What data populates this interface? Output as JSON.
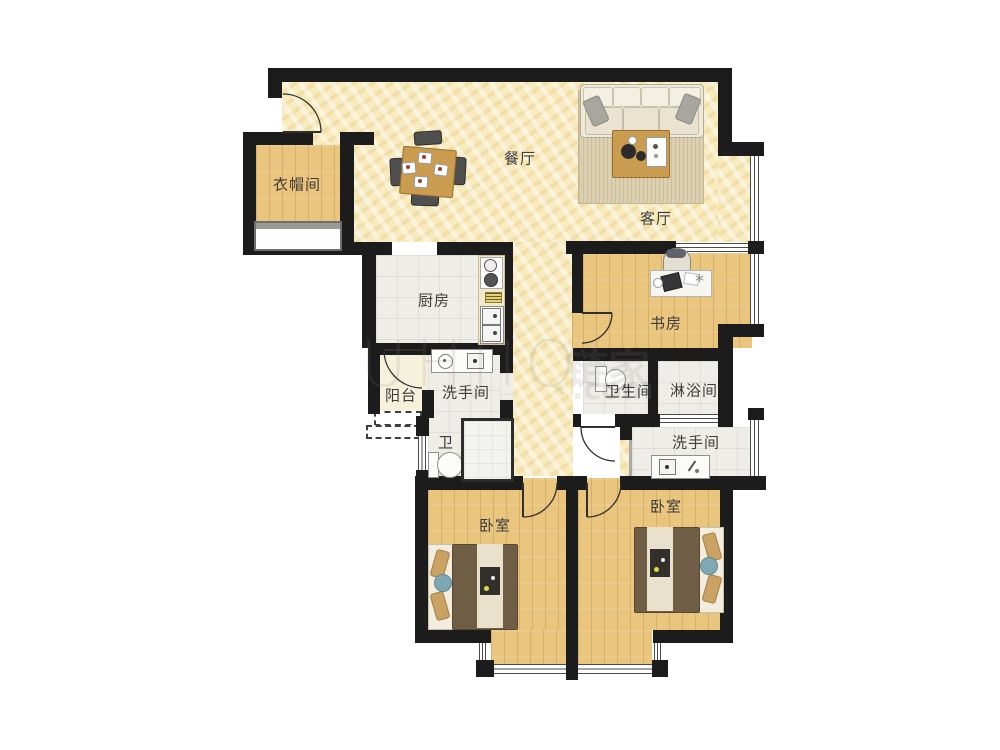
{
  "rooms": [
    {
      "key": "dining",
      "label": "餐厅"
    },
    {
      "key": "living",
      "label": "客厅"
    },
    {
      "key": "cloakroom",
      "label": "衣帽间"
    },
    {
      "key": "kitchen",
      "label": "厨房"
    },
    {
      "key": "study",
      "label": "书房"
    },
    {
      "key": "balcony",
      "label": "阳台"
    },
    {
      "key": "washroom1",
      "label": "洗手间"
    },
    {
      "key": "toilet",
      "label": "卫"
    },
    {
      "key": "bathroom",
      "label": "卫生间"
    },
    {
      "key": "shower",
      "label": "淋浴间"
    },
    {
      "key": "washroom2",
      "label": "洗手间"
    },
    {
      "key": "bedroom-left",
      "label": "卧室"
    },
    {
      "key": "bedroom-right",
      "label": "卧室"
    }
  ],
  "watermark": {
    "latin": "UHJIQ",
    "cjk": "链家",
    "suffix": ".com"
  },
  "palette": {
    "wall": "#1c1c1c",
    "marble_floor": "#f7ebbf",
    "wood_floor": "#e9c57d",
    "tile_floor": "#efede7",
    "balcony_floor": "#f5f1da",
    "furniture_wood": "#c99c4f",
    "bed_duvet": "#6f5e45",
    "label_text": "#3c3c3c"
  }
}
